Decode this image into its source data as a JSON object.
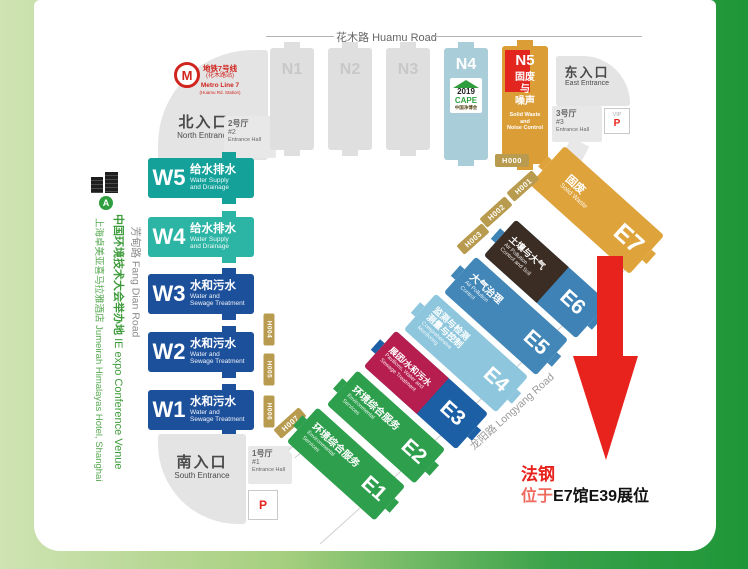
{
  "colors": {
    "bg_left": "#cfe3b3",
    "bg_right": "#1f9638",
    "card": "#ffffff",
    "gray_block": "#dfdfdf",
    "w_teal": "#13a19a",
    "w_teal_light": "#2cb4a4",
    "w_blue": "#1d509b",
    "e_green": "#2e9f4d",
    "e3_top": "#b71e50",
    "e3_bottom": "#1c5fa5",
    "e4_blue": "#8ec7dd",
    "e5_blue": "#4287b8",
    "e6_top": "#3c2d24",
    "e6_bottom": "#3e82b6",
    "e7_orange": "#dfa33b",
    "n4_blue": "#a9cdd9",
    "n5_orange": "#db9d35",
    "n5_red": "#e2251f",
    "corridor_gold": "#b89b4e",
    "metro_red": "#d0251f",
    "venue_green": "#3f9c3c",
    "accent_red": "#e8221c"
  },
  "icons": {
    "metro_logo": "M"
  },
  "roads": {
    "huamu": {
      "zh": "花木路",
      "en": "Huamu Road"
    },
    "fangdian": {
      "zh": "芳甸路",
      "en": "Fang Dian Road"
    },
    "longyang": {
      "zh": "龙阳路",
      "en": "Longyang Road"
    }
  },
  "metro": {
    "line_zh": "地铁7号线",
    "station_zh": "(花木路站)",
    "line_en": "Metro Line 7",
    "station_en": "(Huamu Rd. Station)"
  },
  "entrances": {
    "north": {
      "zh": "北入口",
      "en": "North Entrance"
    },
    "east": {
      "zh": "东入口",
      "en": "East Entrance"
    },
    "south": {
      "zh": "南入口",
      "en": "South Entrance"
    }
  },
  "entrance_halls": {
    "h1": {
      "zh": "1号厅",
      "num": "#1",
      "en": "Entrance Hall"
    },
    "h2": {
      "zh": "2号厅",
      "num": "#2",
      "en": "Entrance Hall"
    },
    "h3": {
      "zh": "3号厅",
      "num": "#3",
      "en": "Entrance Hall"
    }
  },
  "parking": {
    "vip_label": "VIP",
    "p_label": "P"
  },
  "corridors": {
    "h000": "H000",
    "h001": "H001",
    "h002": "H002",
    "h003": "H003",
    "h004": "H004",
    "h005": "H005",
    "h006": "H006",
    "h007": "H007"
  },
  "halls": {
    "north_placeholder": [
      {
        "id": "N1"
      },
      {
        "id": "N2"
      },
      {
        "id": "N3"
      }
    ],
    "n4": {
      "id": "N4",
      "logo_year": "2019",
      "logo_name": "CAPE",
      "logo_cn": "中国净博会"
    },
    "n5": {
      "id": "N5",
      "zh1": "固废",
      "zh2": "与",
      "zh3": "噪声",
      "en1": "Solid Waste",
      "en2": "and",
      "en3": "Noise Control"
    },
    "west": [
      {
        "id": "W5",
        "zh": "给水排水",
        "en1": "Water Supply",
        "en2": "and Drainage"
      },
      {
        "id": "W4",
        "zh": "给水排水",
        "en1": "Water Supply",
        "en2": "and Drainage"
      },
      {
        "id": "W3",
        "zh": "水和污水",
        "en1": "Water and",
        "en2": "Sewage Treatment"
      },
      {
        "id": "W2",
        "zh": "水和污水",
        "en1": "Water and",
        "en2": "Sewage Treatment"
      },
      {
        "id": "W1",
        "zh": "水和污水",
        "en1": "Water and",
        "en2": "Sewage Treatment"
      }
    ],
    "east": [
      {
        "id": "E1",
        "zh": "环境综合服务",
        "en1": "Environmental",
        "en2": "Services"
      },
      {
        "id": "E2",
        "zh": "环境综合服务",
        "en1": "Environmental",
        "en2": "Services"
      },
      {
        "id": "E3",
        "zh": "展团/水和污水",
        "en1": "Pavilions, Water and",
        "en2": "Sewage Treatment"
      },
      {
        "id": "E4",
        "zh1": "监测与检测",
        "zh2": "测量与控制",
        "en1": "Comprehensive",
        "en2": "Monitoring"
      },
      {
        "id": "E5",
        "zh": "大气治理",
        "en1": "Air Pollution",
        "en2": "Control"
      },
      {
        "id": "E6",
        "zh": "土壤与大气",
        "en1": "Air Pollution",
        "en2": "Control and Soil"
      },
      {
        "id": "E7",
        "zh": "固废",
        "en1": "Solid Waste"
      }
    ]
  },
  "venue_note": {
    "badge": "A",
    "line1_zh": "中国环境技术大会举办地",
    "line1_en": "IE expo Conference Venue",
    "line2_zh": "上海卓美亚喜马拉雅酒店",
    "line2_en": "Jumeirah Himalayas Hotel, Shanghai"
  },
  "annotation": {
    "company": "法钢",
    "prefix": "位于",
    "location": "E7馆E39展位"
  }
}
